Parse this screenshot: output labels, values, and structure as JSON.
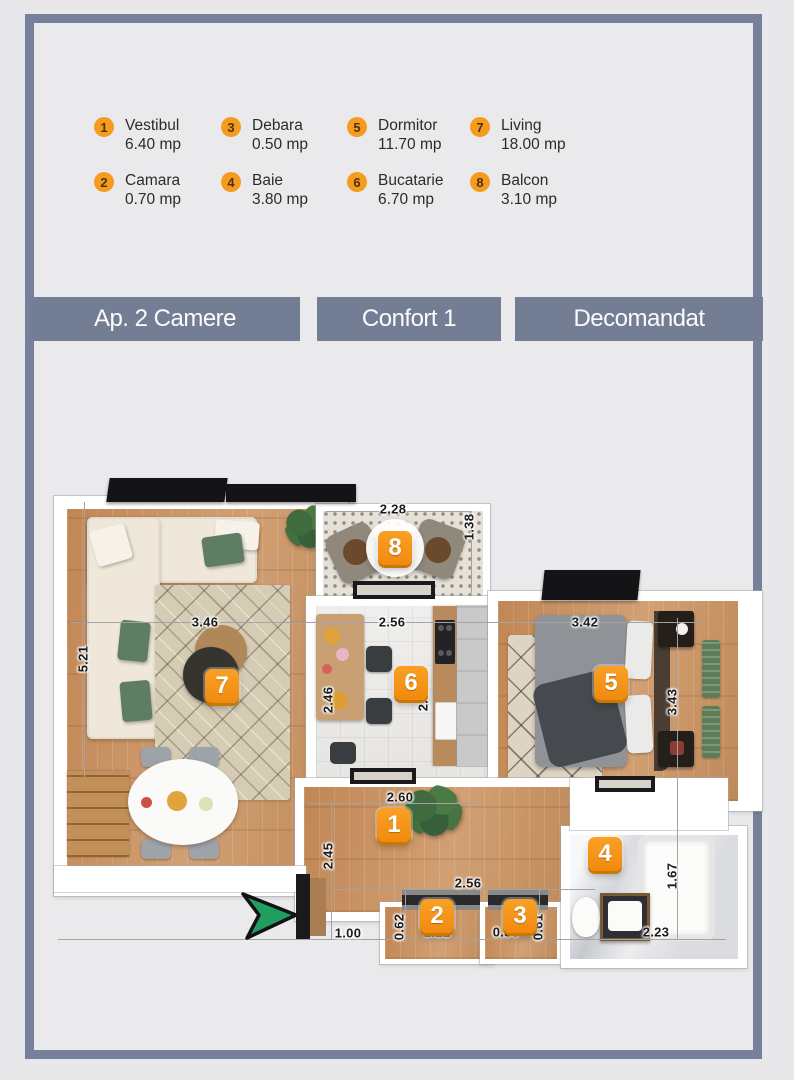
{
  "legend": {
    "items": [
      {
        "num": "1",
        "name": "Vestibul",
        "area": "6.40 mp"
      },
      {
        "num": "2",
        "name": "Camara",
        "area": "0.70 mp"
      },
      {
        "num": "3",
        "name": "Debara",
        "area": "0.50 mp"
      },
      {
        "num": "4",
        "name": "Baie",
        "area": "3.80 mp"
      },
      {
        "num": "5",
        "name": "Dormitor",
        "area": "11.70 mp"
      },
      {
        "num": "6",
        "name": "Bucatarie",
        "area": "6.70 mp"
      },
      {
        "num": "7",
        "name": "Living",
        "area": "18.00 mp"
      },
      {
        "num": "8",
        "name": "Balcon",
        "area": "3.10 mp"
      }
    ]
  },
  "header_bars": [
    {
      "label": "Ap. 2 Camere"
    },
    {
      "label": "Confort 1"
    },
    {
      "label": "Decomandat"
    }
  ],
  "floorplan": {
    "badges": [
      {
        "num": "1"
      },
      {
        "num": "2"
      },
      {
        "num": "3"
      },
      {
        "num": "4"
      },
      {
        "num": "5"
      },
      {
        "num": "6"
      },
      {
        "num": "7"
      },
      {
        "num": "8"
      }
    ],
    "dimensions": [
      {
        "text": "2.28"
      },
      {
        "text": "1.38"
      },
      {
        "text": "3.46"
      },
      {
        "text": "5.21"
      },
      {
        "text": "2.56"
      },
      {
        "text": "3.42"
      },
      {
        "text": "2.46"
      },
      {
        "text": "2.55"
      },
      {
        "text": "3.43"
      },
      {
        "text": "2.60"
      },
      {
        "text": "2.45"
      },
      {
        "text": "2.56"
      },
      {
        "text": "1.00"
      },
      {
        "text": "0.62"
      },
      {
        "text": "1.22"
      },
      {
        "text": "0.80"
      },
      {
        "text": "0.61"
      },
      {
        "text": "2.23"
      },
      {
        "text": "1.67"
      }
    ],
    "colors": {
      "accent_orange": "#F7941E",
      "frame_blue": "#77809A",
      "arrow_green": "#1F9E5F"
    }
  }
}
